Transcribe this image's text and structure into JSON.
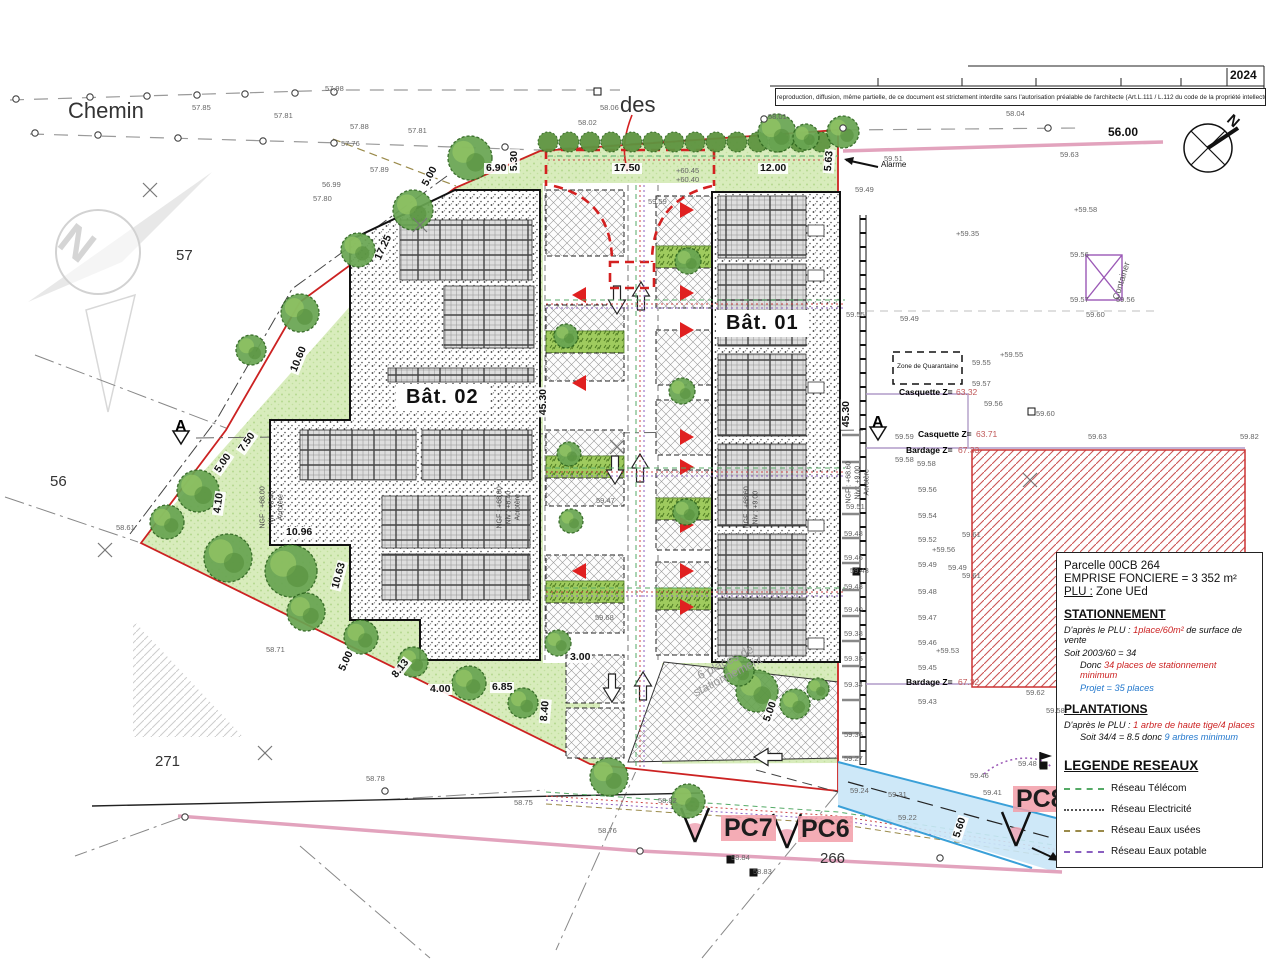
{
  "meta": {
    "year": "2024",
    "copyright": "Toute reproduction, diffusion, même partielle, de ce document est strictement interdite sans l'autorisation préalable de l'architecte (Art.L.111 / L.112 du code de la propriété intellectuelle.)"
  },
  "buildings": {
    "b1": "Bât. 01",
    "b2": "Bât. 02"
  },
  "pc": {
    "pc7": "PC7",
    "pc6": "PC6",
    "pc8": "PC8"
  },
  "info_box": {
    "parcel": "Parcelle 00CB 264",
    "emprise": "EMPRISE FONCIERE = 3 352 m²",
    "plu_label": "PLU :",
    "plu_value": " Zone UEd",
    "s_title": "STATIONNEMENT",
    "s_l1a": "D'après le PLU : ",
    "s_l1b": "1place/60m²",
    "s_l1c": " de surface de vente",
    "s_l2": "Soit    2003/60 =  34",
    "s_l3a": "Donc ",
    "s_l3b": "34 places de stationnement minimum",
    "s_l4a": "Projet = ",
    "s_l4b": " 35 places",
    "p_title": "PLANTATIONS",
    "p_l1a": "D'après le PLU : ",
    "p_l1b": "1 arbre de haute tige/4 places",
    "p_l2a": "Soit 34/4 = 8.5 donc ",
    "p_l2b": "9 arbres minimum",
    "leg_title": "LEGENDE RESEAUX"
  },
  "legend_networks": [
    {
      "label": "Réseau Télécom",
      "color": "#55aa66",
      "style": "dashed"
    },
    {
      "label": "Réseau Electricité",
      "color": "#555555",
      "style": "dotted"
    },
    {
      "label": "Réseau Eaux usées",
      "color": "#9a8a4a",
      "style": "dashed"
    },
    {
      "label": "Réseau Eaux potable",
      "color": "#8a5fc0",
      "style": "dashed"
    }
  ],
  "labels": {
    "elevations": [
      [
        "57.85",
        192,
        104
      ],
      [
        "57.81",
        274,
        112
      ],
      [
        "57.98",
        325,
        85
      ],
      [
        "57.88",
        350,
        123
      ],
      [
        "57.81",
        408,
        127
      ],
      [
        "57.76",
        341,
        140
      ],
      [
        "57.89",
        370,
        166
      ],
      [
        "57.80",
        313,
        195
      ],
      [
        "56.99",
        322,
        181
      ],
      [
        "58.06",
        600,
        104
      ],
      [
        "58.02",
        578,
        119
      ],
      [
        "58.01",
        768,
        113
      ],
      [
        "58.04",
        1006,
        110
      ],
      [
        "59.59",
        648,
        198
      ],
      [
        "+60.45",
        676,
        167
      ],
      [
        "+60.40",
        676,
        176
      ],
      [
        "59.51",
        884,
        155
      ],
      [
        "59.63",
        1060,
        151
      ],
      [
        "59.49",
        855,
        186
      ],
      [
        "+59.35",
        956,
        230
      ],
      [
        "+59.58",
        1074,
        206
      ],
      [
        "59.56",
        1070,
        251
      ],
      [
        "59.57",
        1070,
        296
      ],
      [
        "59.56",
        1116,
        296
      ],
      [
        "59.60",
        1086,
        311
      ],
      [
        "59.55",
        846,
        311
      ],
      [
        "59.49",
        900,
        315
      ],
      [
        "+59.55",
        1000,
        351
      ],
      [
        "59.55",
        972,
        359
      ],
      [
        "59.57",
        972,
        380
      ],
      [
        "59.56",
        984,
        400
      ],
      [
        "59.60",
        1036,
        410
      ],
      [
        "59.59",
        895,
        433
      ],
      [
        "59.63",
        1088,
        433
      ],
      [
        "59.82",
        1240,
        433
      ],
      [
        "59.58",
        895,
        456
      ],
      [
        "59.58",
        917,
        460
      ],
      [
        "59.56",
        918,
        486
      ],
      [
        "59.54",
        918,
        512
      ],
      [
        "59.52",
        918,
        536
      ],
      [
        "59.49",
        918,
        561
      ],
      [
        "59.48",
        918,
        588
      ],
      [
        "59.47",
        918,
        614
      ],
      [
        "59.46",
        918,
        639
      ],
      [
        "59.45",
        918,
        664
      ],
      [
        "59.43",
        918,
        698
      ],
      [
        "59.51",
        846,
        503
      ],
      [
        "59.48",
        844,
        530
      ],
      [
        "59.46",
        844,
        554
      ],
      [
        "59.43",
        850,
        567
      ],
      [
        "59.43",
        844,
        583
      ],
      [
        "59.40",
        844,
        606
      ],
      [
        "59.38",
        844,
        630
      ],
      [
        "59.35",
        844,
        655
      ],
      [
        "59.34",
        844,
        681
      ],
      [
        "59.36",
        844,
        731
      ],
      [
        "59.27",
        844,
        755
      ],
      [
        "59.61",
        962,
        531
      ],
      [
        "+59.56",
        932,
        546
      ],
      [
        "59.49",
        948,
        564
      ],
      [
        "59.61",
        962,
        572
      ],
      [
        "+59.53",
        936,
        647
      ],
      [
        "59.62",
        1026,
        689
      ],
      [
        "59.58",
        1046,
        707
      ],
      [
        "59.46",
        970,
        772
      ],
      [
        "59.48",
        1018,
        760
      ],
      [
        "59.41",
        983,
        789
      ],
      [
        "59.24",
        850,
        787
      ],
      [
        "59.31",
        888,
        791
      ],
      [
        "59.22",
        898,
        814
      ],
      [
        "58.82",
        658,
        797
      ],
      [
        "58.84",
        731,
        854
      ],
      [
        "58.83",
        753,
        868
      ],
      [
        "58.78",
        366,
        775
      ],
      [
        "58.75",
        514,
        799
      ],
      [
        "58.76",
        598,
        827
      ],
      [
        "58.71",
        266,
        646
      ],
      [
        "58.61",
        116,
        524
      ],
      [
        "59.68",
        595,
        614
      ],
      [
        "59.47",
        596,
        497
      ]
    ],
    "dimensions": [
      [
        "17.50",
        612,
        163,
        0
      ],
      [
        "12.00",
        758,
        163,
        0
      ],
      [
        "6.90",
        484,
        163,
        0
      ],
      [
        "5.30",
        514,
        168,
        -90
      ],
      [
        "5.00",
        424,
        182,
        -62
      ],
      [
        "17.25",
        377,
        256,
        -65
      ],
      [
        "10.60",
        293,
        368,
        -68
      ],
      [
        "7.50",
        240,
        447,
        -55
      ],
      [
        "5.00",
        216,
        468,
        -55
      ],
      [
        "4.10",
        217,
        510,
        -82
      ],
      [
        "10.96",
        284,
        527,
        0
      ],
      [
        "10.63",
        335,
        585,
        -75
      ],
      [
        "5.00",
        341,
        667,
        -65
      ],
      [
        "8.13",
        393,
        673,
        -52
      ],
      [
        "4.00",
        428,
        684,
        0
      ],
      [
        "6.85",
        490,
        682,
        0
      ],
      [
        "3.00",
        568,
        652,
        0
      ],
      [
        "8.40",
        544,
        718,
        -85
      ],
      [
        "5.00",
        766,
        718,
        -70
      ],
      [
        "45.30",
        543,
        412,
        -90
      ],
      [
        "45.30",
        846,
        424,
        -90
      ],
      [
        "5.63",
        828,
        168,
        -85
      ],
      [
        "5.60",
        956,
        834,
        -72
      ]
    ],
    "annotations": [
      {
        "t": "Chemin",
        "x": 68,
        "y": 100,
        "s": 22,
        "c": "#333"
      },
      {
        "t": "des",
        "x": 620,
        "y": 94,
        "s": 22,
        "c": "#333"
      },
      {
        "t": "2024",
        "x": 1230,
        "y": 69,
        "s": 12,
        "c": "#111",
        "b": 1
      },
      {
        "t": "56.00",
        "x": 1108,
        "y": 126,
        "s": 12,
        "c": "#111",
        "b": 1
      },
      {
        "t": "57",
        "x": 176,
        "y": 248,
        "s": 15,
        "c": "#333"
      },
      {
        "t": "56",
        "x": 50,
        "y": 474,
        "s": 15,
        "c": "#333"
      },
      {
        "t": "271",
        "x": 155,
        "y": 754,
        "s": 15,
        "c": "#333"
      },
      {
        "t": "266",
        "x": 820,
        "y": 851,
        "s": 15,
        "c": "#333"
      },
      {
        "t": "Alarme",
        "x": 881,
        "y": 161,
        "s": 8,
        "c": "#111"
      },
      {
        "t": "Container",
        "x": 1116,
        "y": 295,
        "s": 9,
        "c": "#555",
        "r": -73
      },
      {
        "t": "Zone de Quarantaine",
        "x": 897,
        "y": 364,
        "s": 6.5,
        "c": "#111"
      },
      {
        "t": "Casquette Z=",
        "x": 899,
        "y": 388,
        "s": 8.5,
        "b": 1
      },
      {
        "t": "63.32",
        "x": 956,
        "y": 388,
        "s": 8.5,
        "c": "#c05858"
      },
      {
        "t": "Casquette Z=",
        "x": 918,
        "y": 430,
        "s": 8.5,
        "b": 1
      },
      {
        "t": "63.71",
        "x": 976,
        "y": 430,
        "s": 8.5,
        "c": "#c05858"
      },
      {
        "t": "Bardage Z=",
        "x": 906,
        "y": 446,
        "s": 8.5,
        "b": 1
      },
      {
        "t": "67.33",
        "x": 958,
        "y": 446,
        "s": 8.5,
        "c": "#c05858"
      },
      {
        "t": "Bardage Z=",
        "x": 906,
        "y": 678,
        "s": 8.5,
        "b": 1
      },
      {
        "t": "67.32",
        "x": 958,
        "y": 678,
        "s": 8.5,
        "c": "#c05858"
      },
      {
        "t": "A",
        "x": 175,
        "y": 419,
        "s": 16,
        "b": 1
      },
      {
        "t": "A",
        "x": 872,
        "y": 415,
        "s": 16,
        "b": 1
      },
      {
        "t": "N",
        "x": 64,
        "y": 212,
        "s": 44,
        "c": "#d5d5d5",
        "r": 38,
        "b": 1
      },
      {
        "t": "N",
        "x": 1229,
        "y": 110,
        "s": 15,
        "c": "#111",
        "r": 42,
        "b": 1
      },
      {
        "t": "6 places de",
        "x": 698,
        "y": 670,
        "s": 12,
        "c": "#999",
        "r": -27
      },
      {
        "t": "stationnement",
        "x": 694,
        "y": 687,
        "s": 12,
        "c": "#999",
        "r": -27
      },
      {
        "t": "NGF : +68.00",
        "x": 263,
        "y": 525,
        "s": 7,
        "c": "#444",
        "r": -90
      },
      {
        "t": "Niv : +8.40",
        "x": 272,
        "y": 521,
        "s": 7,
        "c": "#444",
        "r": -90
      },
      {
        "t": "Acrotère",
        "x": 281,
        "y": 517,
        "s": 7,
        "c": "#444",
        "r": -90
      },
      {
        "t": "NGF : +68.00",
        "x": 500,
        "y": 525,
        "s": 7,
        "c": "#444",
        "r": -90
      },
      {
        "t": "Niv : +8.40",
        "x": 509,
        "y": 521,
        "s": 7,
        "c": "#444",
        "r": -90
      },
      {
        "t": "Acrotère",
        "x": 518,
        "y": 517,
        "s": 7,
        "c": "#444",
        "r": -90
      },
      {
        "t": "NGF : +68.60",
        "x": 747,
        "y": 525,
        "s": 7,
        "c": "#444",
        "r": -90
      },
      {
        "t": "Niv : +9.00",
        "x": 756,
        "y": 521,
        "s": 7,
        "c": "#444",
        "r": -90
      },
      {
        "t": "NGF : +68.60",
        "x": 849,
        "y": 500,
        "s": 7,
        "c": "#444",
        "r": -90
      },
      {
        "t": "Niv : +9.00",
        "x": 858,
        "y": 496,
        "s": 7,
        "c": "#444",
        "r": -90
      },
      {
        "t": "Acrotère",
        "x": 867,
        "y": 492,
        "s": 7,
        "c": "#444",
        "r": -90
      }
    ]
  },
  "site": {
    "trees": [
      [
        470,
        158,
        22
      ],
      [
        413,
        210,
        20
      ],
      [
        358,
        250,
        17
      ],
      [
        300,
        313,
        19
      ],
      [
        251,
        350,
        15
      ],
      [
        198,
        491,
        21
      ],
      [
        167,
        522,
        17
      ],
      [
        228,
        558,
        24
      ],
      [
        291,
        571,
        26
      ],
      [
        306,
        612,
        19
      ],
      [
        361,
        637,
        17
      ],
      [
        413,
        662,
        15
      ],
      [
        469,
        683,
        17
      ],
      [
        523,
        703,
        15
      ],
      [
        558,
        643,
        13
      ],
      [
        609,
        777,
        19
      ],
      [
        688,
        801,
        17
      ],
      [
        757,
        691,
        21
      ],
      [
        795,
        704,
        15
      ],
      [
        688,
        261,
        13
      ],
      [
        682,
        391,
        13
      ],
      [
        686,
        512,
        13
      ],
      [
        566,
        336,
        12
      ],
      [
        569,
        454,
        12
      ],
      [
        571,
        521,
        12
      ],
      [
        739,
        671,
        15
      ],
      [
        818,
        689,
        11
      ],
      [
        777,
        133,
        19
      ],
      [
        806,
        137,
        13
      ],
      [
        843,
        132,
        16
      ]
    ],
    "hedge": {
      "x1": 548,
      "x2": 838,
      "y": 142,
      "r": 10,
      "step": 21
    },
    "survey_points": [
      [
        16,
        99
      ],
      [
        90,
        97
      ],
      [
        147,
        96
      ],
      [
        197,
        95
      ],
      [
        245,
        94
      ],
      [
        295,
        93
      ],
      [
        334,
        92
      ],
      [
        35,
        133
      ],
      [
        98,
        135
      ],
      [
        178,
        138
      ],
      [
        263,
        141
      ],
      [
        334,
        143
      ],
      [
        505,
        147
      ],
      [
        764,
        119
      ],
      [
        843,
        128
      ],
      [
        1048,
        128
      ],
      [
        185,
        817
      ],
      [
        385,
        791
      ],
      [
        640,
        851
      ],
      [
        940,
        858
      ]
    ],
    "x_marks": [
      [
        150,
        190
      ],
      [
        105,
        550
      ],
      [
        265,
        753
      ],
      [
        1030,
        480
      ],
      [
        617,
        447
      ],
      [
        420,
        225
      ]
    ],
    "squares": [
      [
        853,
        568,
        "#111"
      ],
      [
        1040,
        762,
        "#111"
      ],
      [
        727,
        856,
        "#111"
      ],
      [
        750,
        869,
        "#111"
      ],
      [
        594,
        88,
        "#fff"
      ],
      [
        1028,
        408,
        "#fff"
      ]
    ]
  },
  "parking": {
    "left_bays": [
      [
        546,
        190,
        78,
        66,
        "h"
      ],
      [
        546,
        305,
        78,
        26,
        "h"
      ],
      [
        546,
        331,
        78,
        22,
        "g"
      ],
      [
        546,
        353,
        78,
        28,
        "h"
      ],
      [
        546,
        430,
        78,
        26,
        "h"
      ],
      [
        546,
        456,
        78,
        22,
        "g"
      ],
      [
        546,
        478,
        78,
        28,
        "h"
      ],
      [
        546,
        555,
        78,
        26,
        "h"
      ],
      [
        546,
        581,
        78,
        22,
        "g"
      ],
      [
        546,
        603,
        78,
        30,
        "h"
      ]
    ],
    "right_bays": [
      [
        656,
        196,
        56,
        50,
        "h"
      ],
      [
        656,
        246,
        56,
        22,
        "g"
      ],
      [
        656,
        268,
        56,
        40,
        "h"
      ],
      [
        656,
        330,
        56,
        55,
        "h"
      ],
      [
        656,
        400,
        56,
        55,
        "h"
      ],
      [
        656,
        470,
        56,
        28,
        "h"
      ],
      [
        656,
        498,
        56,
        22,
        "g"
      ],
      [
        656,
        520,
        56,
        30,
        "h"
      ],
      [
        656,
        562,
        56,
        26,
        "h"
      ],
      [
        656,
        588,
        56,
        22,
        "g"
      ],
      [
        656,
        610,
        56,
        45,
        "h"
      ]
    ],
    "bottom_bays": [
      [
        566,
        655,
        58,
        48,
        "h"
      ],
      [
        566,
        708,
        58,
        50,
        "h"
      ]
    ],
    "triangles_left": [
      295,
      383,
      571
    ],
    "triangles_right": [
      210,
      293,
      330,
      437,
      467,
      525,
      571,
      607
    ],
    "arrows": [
      [
        617,
        300,
        "d"
      ],
      [
        641,
        296,
        "u"
      ],
      [
        615,
        470,
        "d"
      ],
      [
        640,
        468,
        "u"
      ],
      [
        612,
        688,
        "d"
      ],
      [
        643,
        686,
        "u"
      ],
      [
        768,
        757,
        "l"
      ]
    ]
  }
}
